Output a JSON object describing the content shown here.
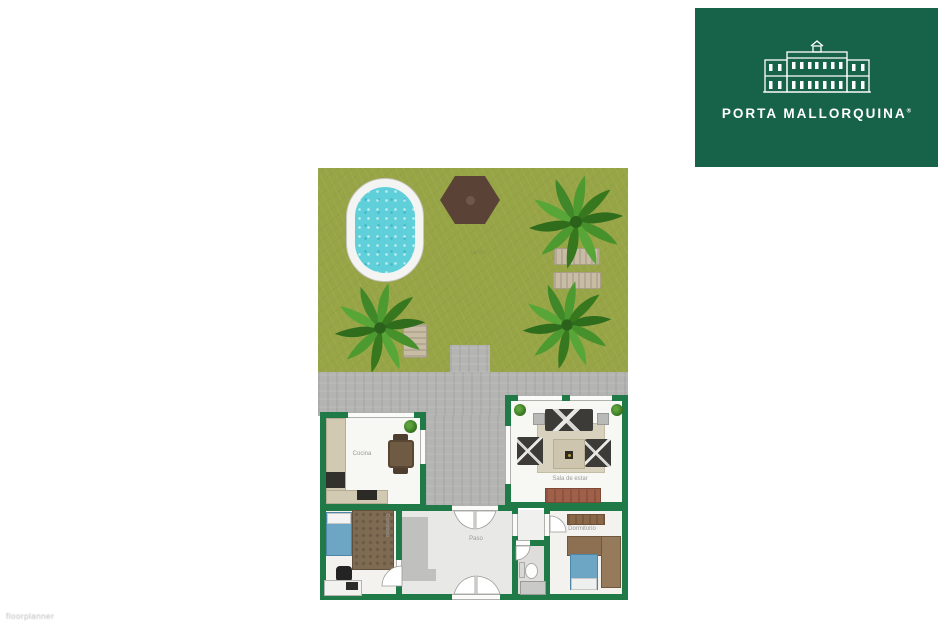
{
  "logo": {
    "brand": "PORTA MALLORQUINA",
    "registered": "®",
    "building_icon": "finca-facade-icon"
  },
  "watermark": "floorplanner",
  "floorplan": {
    "garden": {
      "label": "Jardín",
      "feature_icons": [
        "pool",
        "hexagon-pergola",
        "palm-tree",
        "sun-lounger",
        "stone-path"
      ]
    },
    "rooms": {
      "kitchen": {
        "label": "Cocina"
      },
      "living": {
        "label": "Sala de estar"
      },
      "hall": {
        "label": "Paso"
      },
      "bedroom_right": {
        "label": "Dormitorio"
      },
      "bedroom_left": {
        "label": "Dormitorio"
      },
      "bathroom": {
        "label": ""
      }
    }
  },
  "colors": {
    "logoGreen": "#176349",
    "wall": "#1f7a47",
    "grass": "#98a546",
    "terrace": "#b4b4b2",
    "water": "#5fd0da",
    "poolDeck": "#f4f4f2",
    "hex": "#5a4237",
    "floor": "#f7f7f4",
    "hallFloor": "#e8e8e6",
    "bathFloor": "#dedddb",
    "rug": "#d8d1bd",
    "sofa": "#3c3b38",
    "wood": "#8a6748",
    "terracotta": "#a05f49",
    "bedBlue": "#6ca6c4",
    "counter": "#d2c9b2",
    "lounger": "#c8bda4"
  }
}
